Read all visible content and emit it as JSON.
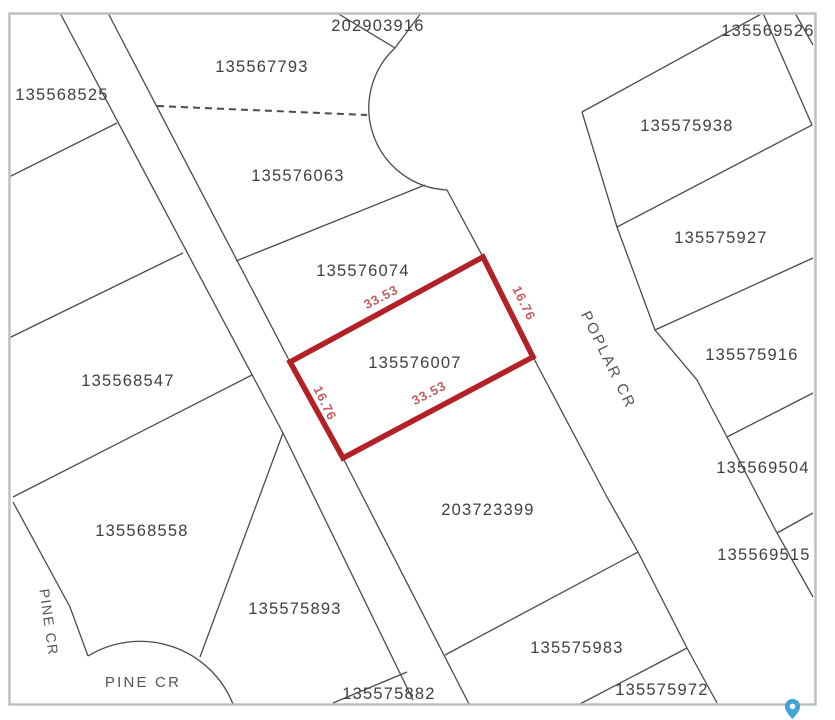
{
  "parcels": [
    {
      "id": "202903916"
    },
    {
      "id": "135569526"
    },
    {
      "id": "135567793"
    },
    {
      "id": "135568525"
    },
    {
      "id": "135575938"
    },
    {
      "id": "135576063"
    },
    {
      "id": "135575927"
    },
    {
      "id": "135576074"
    },
    {
      "id": "135575916"
    },
    {
      "id": "135568547"
    },
    {
      "id": "135569504"
    },
    {
      "id": "203723399"
    },
    {
      "id": "135568558"
    },
    {
      "id": "135569515"
    },
    {
      "id": "135575893"
    },
    {
      "id": "135575983"
    },
    {
      "id": "135575972"
    },
    {
      "id": "135575882"
    }
  ],
  "highlight": {
    "id": "135576007",
    "edges": {
      "top": "33.53",
      "right": "16.76",
      "bottom": "33.53",
      "left": "16.76"
    }
  },
  "streets": {
    "pine_cr_side": "PINE CR",
    "pine_cr_culdesac": "PINE CR",
    "poplar_cr": "POPLAR CR"
  },
  "colors": {
    "highlight": "#b32025",
    "dimension_text": "#c4605f",
    "boundary": "#4b4b4b",
    "label": "#3f3f3f",
    "frame": "#bcc0c2",
    "pin": "#41a3d6"
  }
}
